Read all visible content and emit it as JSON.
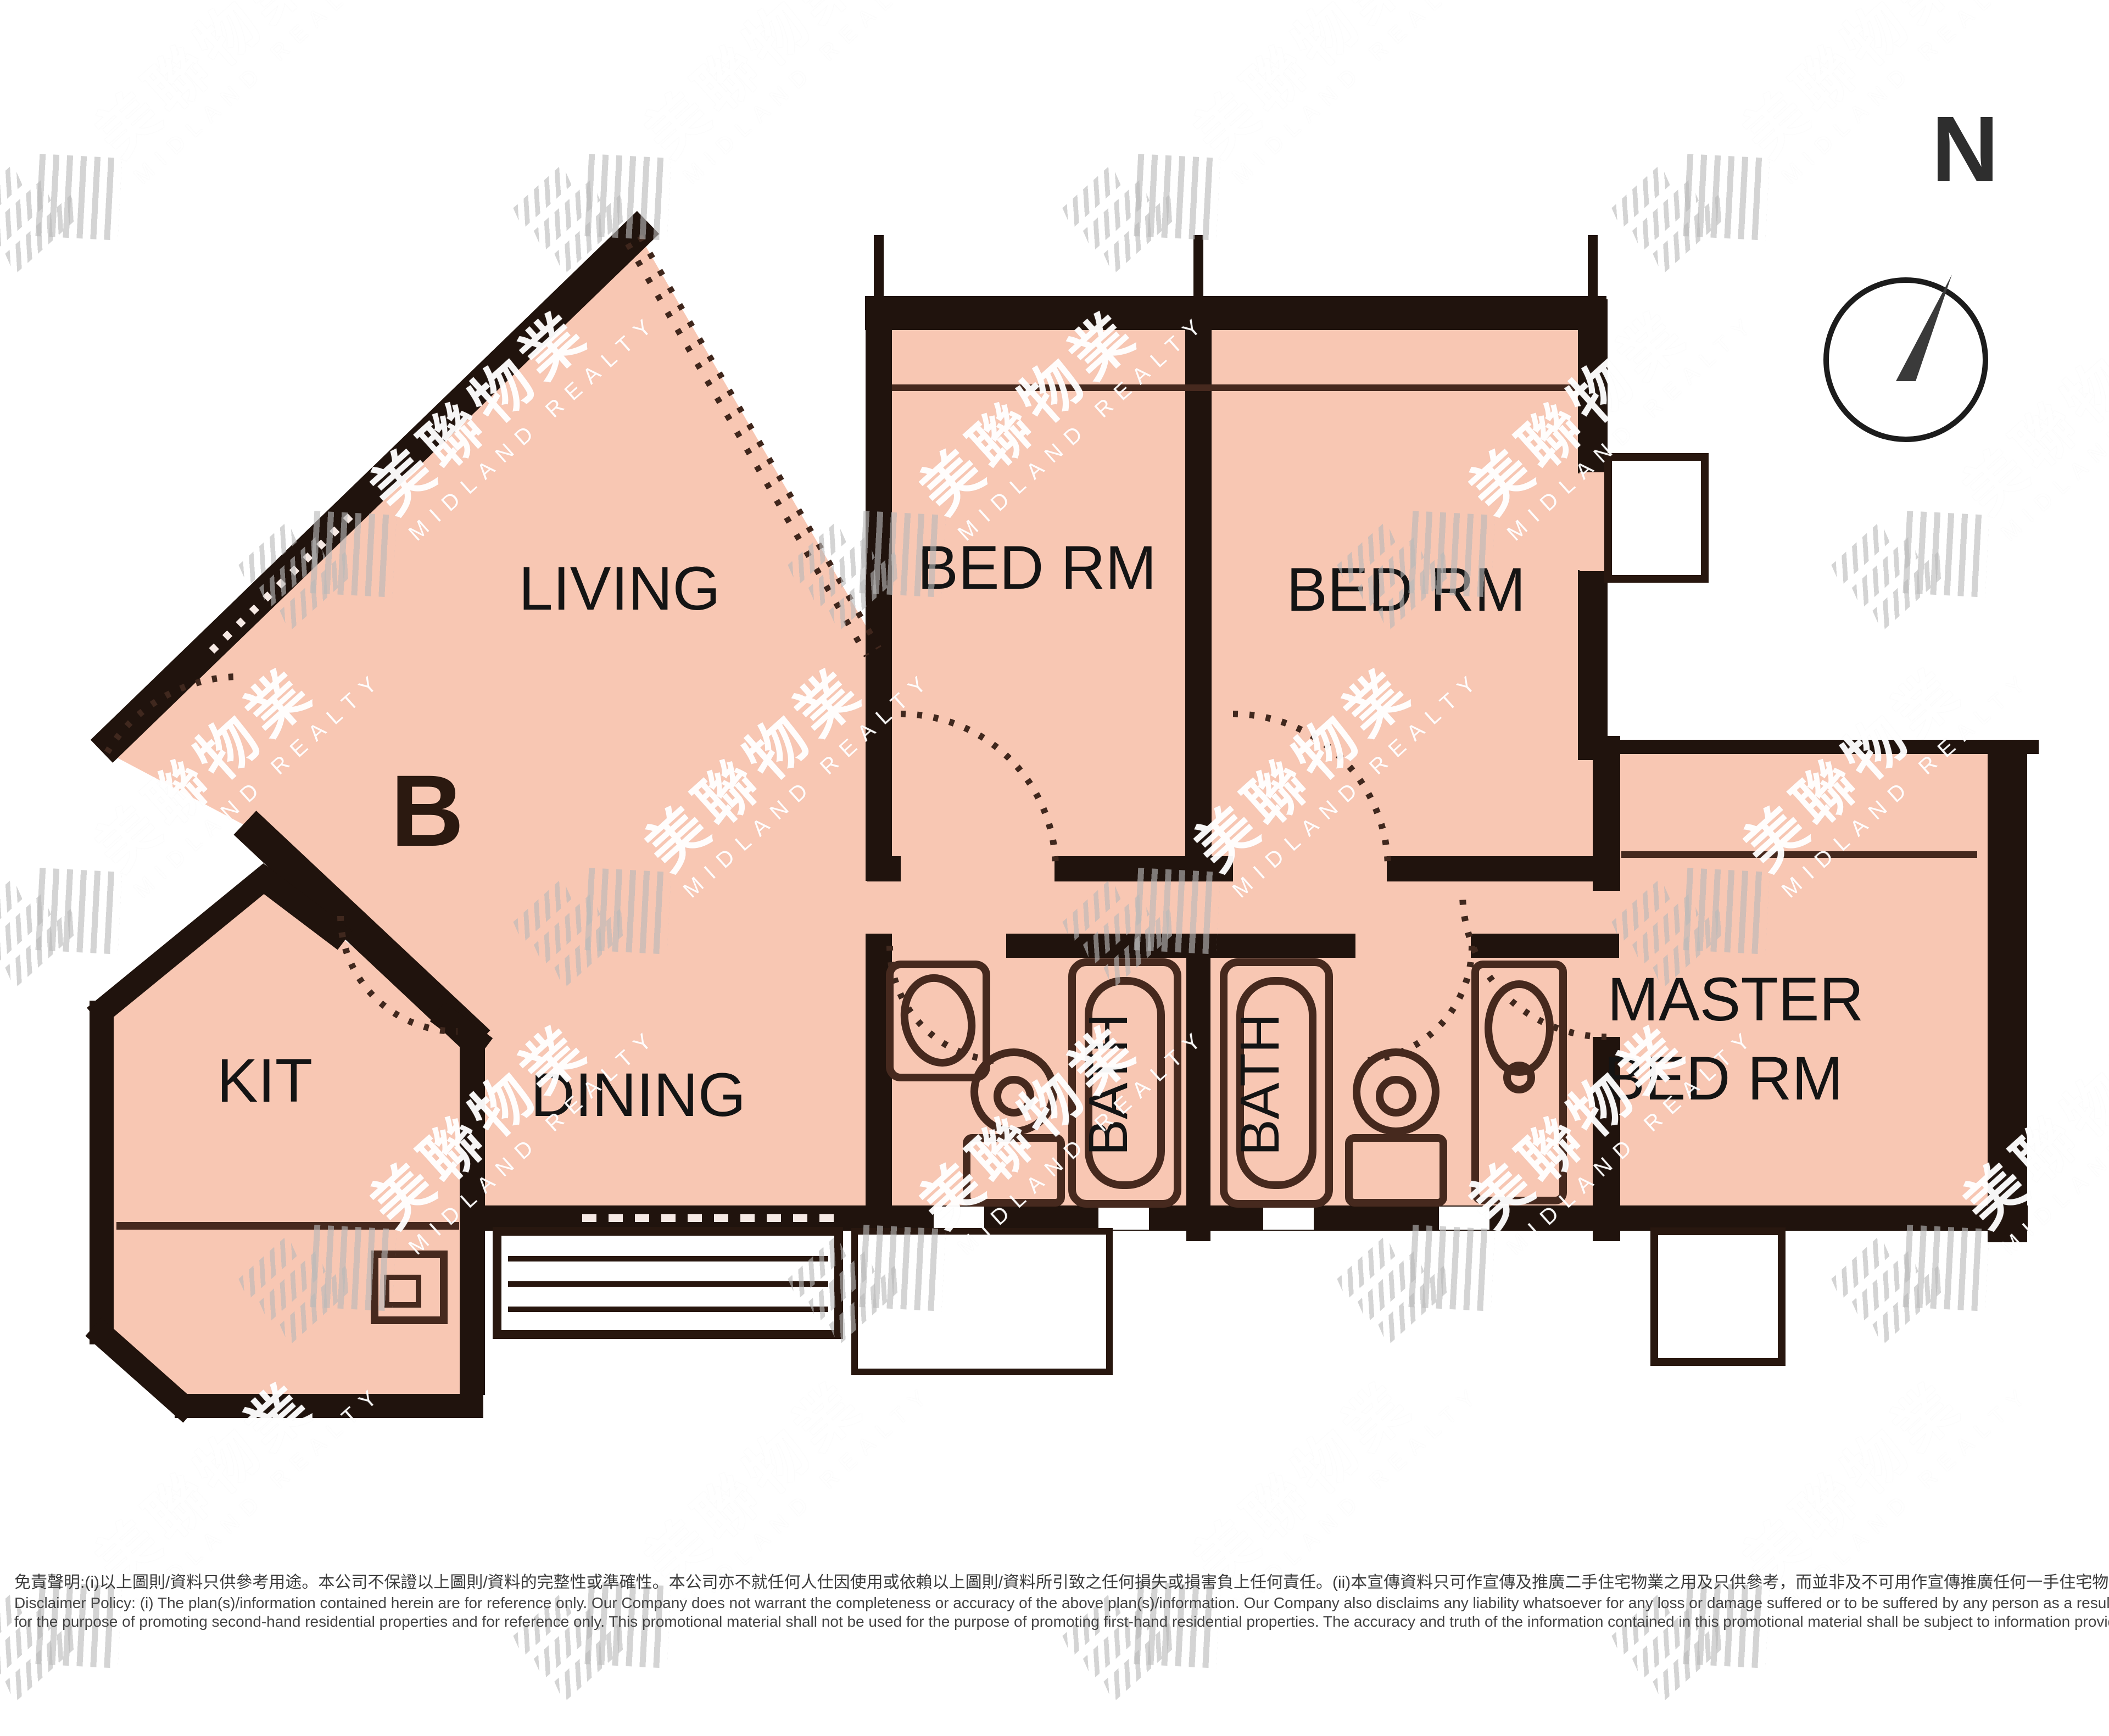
{
  "labels": {
    "living": "LIVING",
    "bed_rm_1": "BED RM",
    "bed_rm_2": "BED RM",
    "master_bed_line1": "MASTER",
    "master_bed_line2": "BED RM",
    "dining": "DINING",
    "kitchen": "KIT",
    "bath_1": "BATH",
    "bath_2": "BATH",
    "unit": "B",
    "compass_north": "N"
  },
  "watermark": {
    "cn": "美聯物業",
    "en": "MIDLAND REALTY"
  },
  "disclaimer": {
    "zh": "免責聲明:(i)以上圖則/資料只供參考用途。本公司不保證以上圖則/資料的完整性或準確性。本公司亦不就任何人仕因使用或依賴以上圖則/資料所引致之任何損失或損害負上任何責任。(ii)本宣傳資料只可作宣傳及推廣二手住宅物業之用及只供參考，而並非及不可用作宣傳推廣任何一手住宅物業，其準確性及真實性以樓盤發展商提供的資料為準。",
    "en1": "Disclaimer Policy: (i) The plan(s)/information contained herein are for reference only. Our Company does not warrant the completeness or accuracy of the above plan(s)/information. Our Company also disclaims any liability whatsoever for any loss or damage suffered or to be suffered by any person as a result of using or relying on the plan(s)/information. (ii) This promotional material is",
    "en2": "for the purpose of promoting second-hand residential properties and for reference only. This promotional material shall not be used for the purpose of promoting first-hand residential properties. The accuracy and truth of the information contained in this promotional material shall be subject to information provided by the developers."
  },
  "colors": {
    "room_fill": "#f8c7b3",
    "wall": "#20130d",
    "line": "#46291e",
    "text": "#141414"
  }
}
